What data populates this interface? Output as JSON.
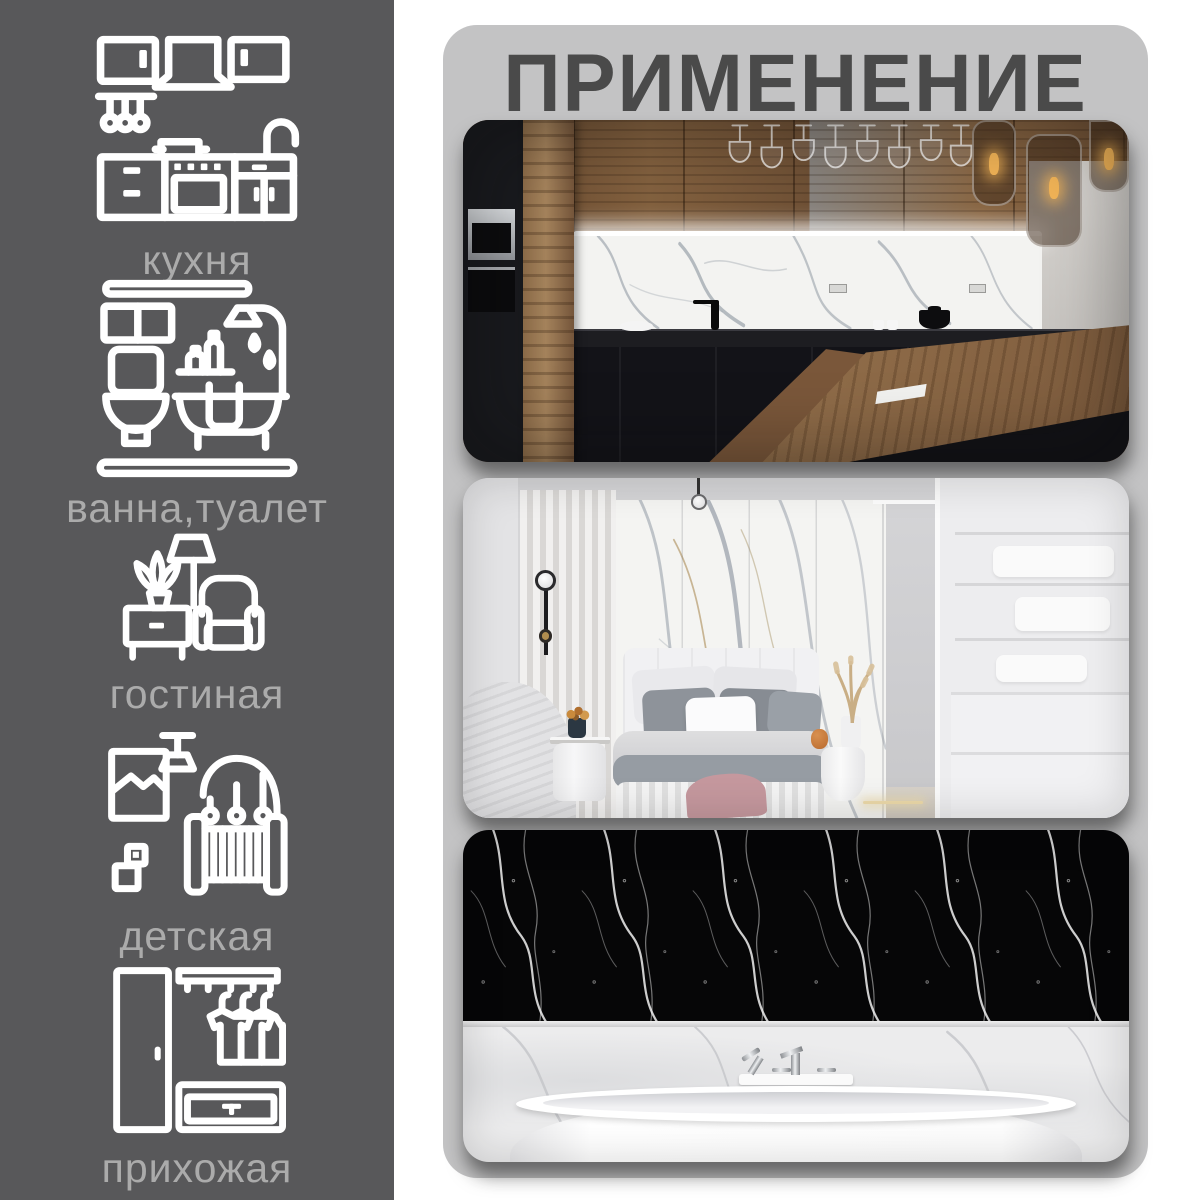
{
  "panel": {
    "title": "ПРИМЕНЕНИЕ",
    "photos": [
      {
        "name": "kitchen-photo",
        "description": "Кухня: белый мраморный фартук с подсветкой, деревянные верхние шкафы, чёрные нижние шкафы и деревянный остров"
      },
      {
        "name": "bedroom-photo",
        "description": "Спальня: стена из белого мрамора за кроватью, светлый интерьер"
      },
      {
        "name": "bathroom-photo",
        "description": "Ванная: стена из чёрного мрамора над белой отдельностоящей ванной"
      }
    ]
  },
  "sidebar": {
    "items": [
      {
        "id": "kitchen",
        "icon": "kitchen-icon",
        "label": "кухня"
      },
      {
        "id": "bathroom",
        "icon": "bathroom-icon",
        "label": "ванна,туалет"
      },
      {
        "id": "living-room",
        "icon": "living-room-icon",
        "label": "гостиная"
      },
      {
        "id": "nursery",
        "icon": "nursery-icon",
        "label": "детская"
      },
      {
        "id": "hallway",
        "icon": "hallway-icon",
        "label": "прихожая"
      }
    ]
  },
  "theme": {
    "sidebar_bg": "#58585a",
    "panel_bg": "#c3c3c4",
    "title_color": "#4a4a4a",
    "label_color": "#ababab",
    "icon_color": "#ffffff"
  }
}
